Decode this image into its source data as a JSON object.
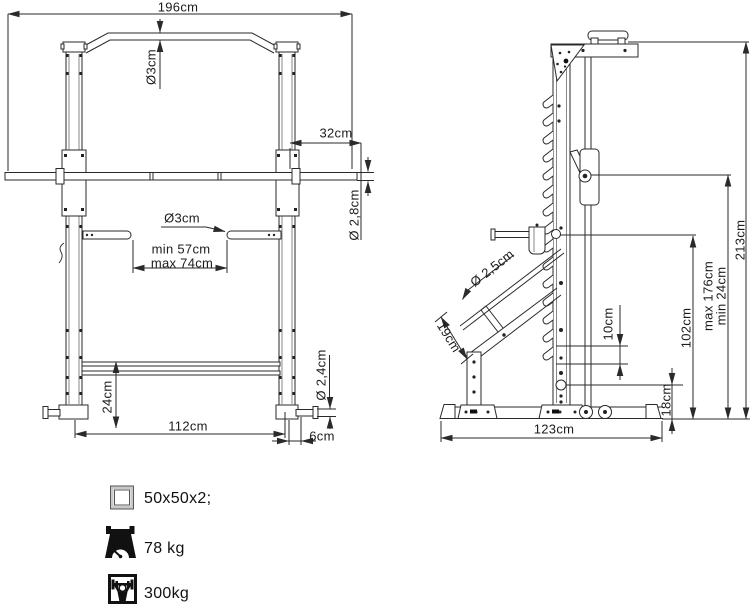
{
  "front_view": {
    "labels": {
      "overall_width": "196cm",
      "top_bar_diameter": "Ø3cm",
      "bar_end_offset": "32cm",
      "barbell_diameter": "Ø 2,8cm",
      "catcher_diameter": "Ø3cm",
      "catcher_min_width": "min 57cm",
      "catcher_max_width": "max 74cm",
      "rear_bar_height": "24cm",
      "inner_width": "112cm",
      "peg_offset": "6cm",
      "peg_diameter": "Ø 2,4cm"
    }
  },
  "side_view": {
    "labels": {
      "attachment_diameter": "Ø 2,5cm",
      "attachment_length": "19cm",
      "hook_spacing": "10cm",
      "stopper_height": "102cm",
      "bar_max_height": "max 176cm",
      "bar_min_height": "min 24cm",
      "total_height": "213cm",
      "plate_peg_height": "18cm",
      "base_depth": "123cm"
    }
  },
  "legend": {
    "items": [
      {
        "icon": "tube-profile-icon",
        "label": "50x50x2;"
      },
      {
        "icon": "weight-scale-icon",
        "label": "78 kg"
      },
      {
        "icon": "max-load-icon",
        "label": "300kg"
      }
    ]
  }
}
